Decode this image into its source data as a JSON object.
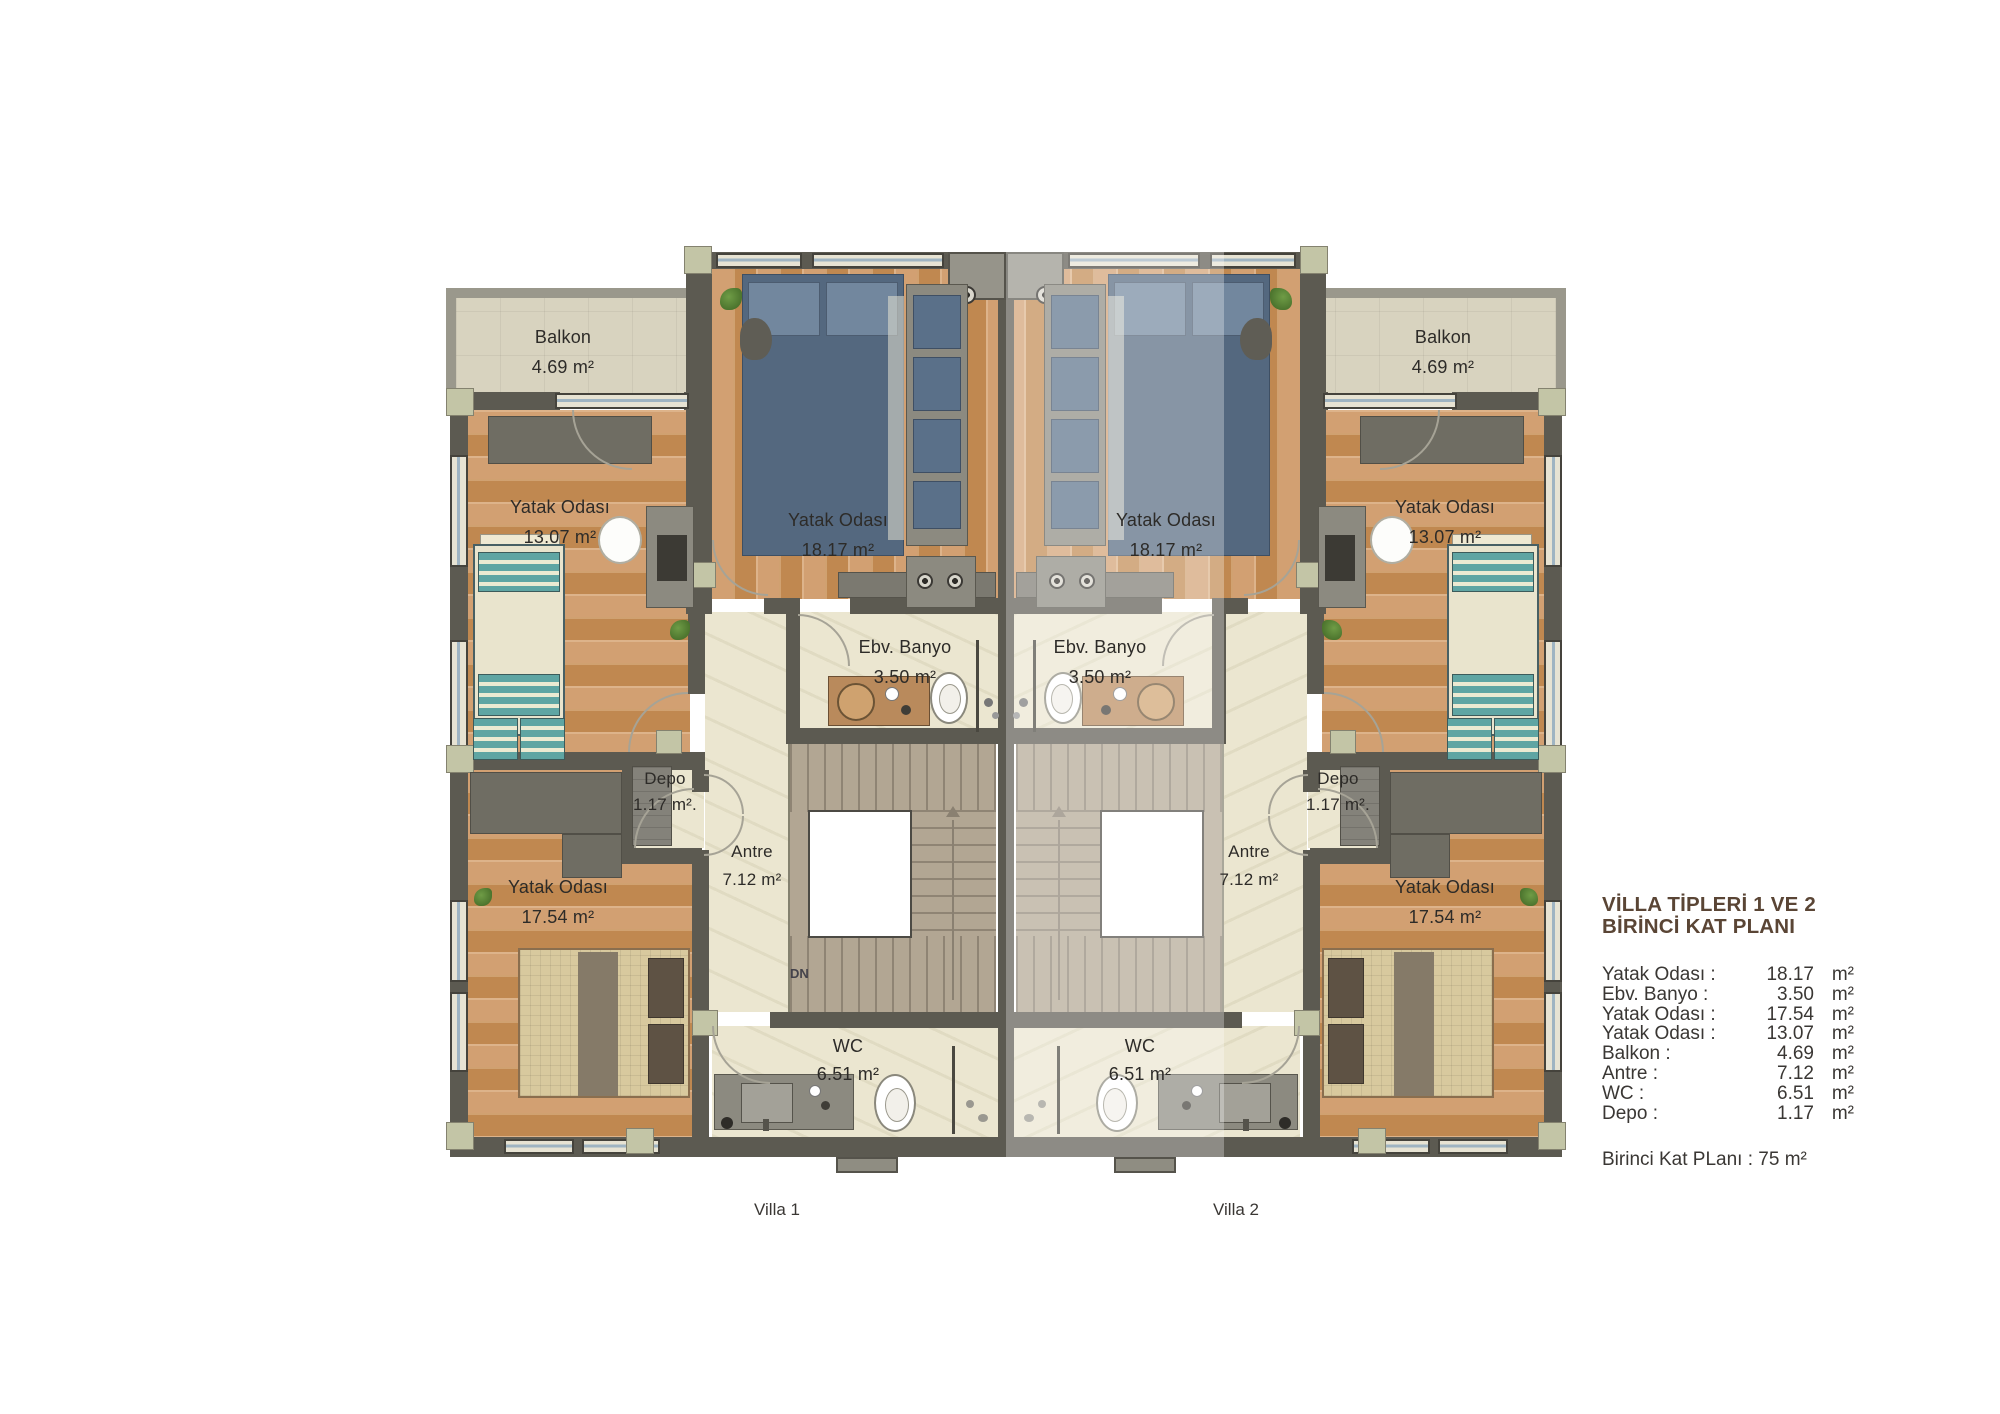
{
  "legend": {
    "title_line1": "VİLLA TİPLERİ 1 VE 2",
    "title_line2": "BİRİNCİ KAT PLANI",
    "rows": [
      {
        "label": "Yatak Odası :",
        "value": "18.17",
        "unit": "m²"
      },
      {
        "label": "Ebv. Banyo :",
        "value": "3.50",
        "unit": "m²"
      },
      {
        "label": "Yatak Odası :",
        "value": "17.54",
        "unit": "m²"
      },
      {
        "label": "Yatak Odası :",
        "value": "13.07",
        "unit": "m²"
      },
      {
        "label": "Balkon :",
        "value": "4.69",
        "unit": "m²"
      },
      {
        "label": "Antre :",
        "value": "7.12",
        "unit": "m²"
      },
      {
        "label": "WC :",
        "value": "6.51",
        "unit": "m²"
      },
      {
        "label": "Depo :",
        "value": "1.17",
        "unit": "m²"
      }
    ],
    "footer": "Birinci Kat PLanı : 75 m²"
  },
  "rooms": {
    "balkon": {
      "name": "Balkon",
      "area": "4.69 m²"
    },
    "yatak_13": {
      "name": "Yatak Odası",
      "area": "13.07 m²"
    },
    "yatak_18": {
      "name": "Yatak Odası",
      "area": "18.17 m²"
    },
    "ebv_banyo": {
      "name": "Ebv. Banyo",
      "area": "3.50 m²"
    },
    "depo": {
      "name": "Depo",
      "area": "1.17 m²."
    },
    "antre": {
      "name": "Antre",
      "area": "7.12 m²"
    },
    "yatak_17": {
      "name": "Yatak Odası",
      "area": "17.54 m²"
    },
    "wc": {
      "name": "WC",
      "area": "6.51 m²"
    }
  },
  "labels": {
    "villa1": "Villa 1",
    "villa2": "Villa 2",
    "stairs_down": "DN"
  },
  "colors": {
    "legend_title": "#5a4535",
    "body_text": "#3a3734",
    "wall": "#5c5a51",
    "wood_floor": "#c9935f",
    "cream_floor": "#ebe6d0",
    "balcony_floor": "#d8d3bf",
    "stairs": "#b2a693",
    "teal_bed": "#5fa5a3",
    "navy_bed": "#54687f"
  }
}
